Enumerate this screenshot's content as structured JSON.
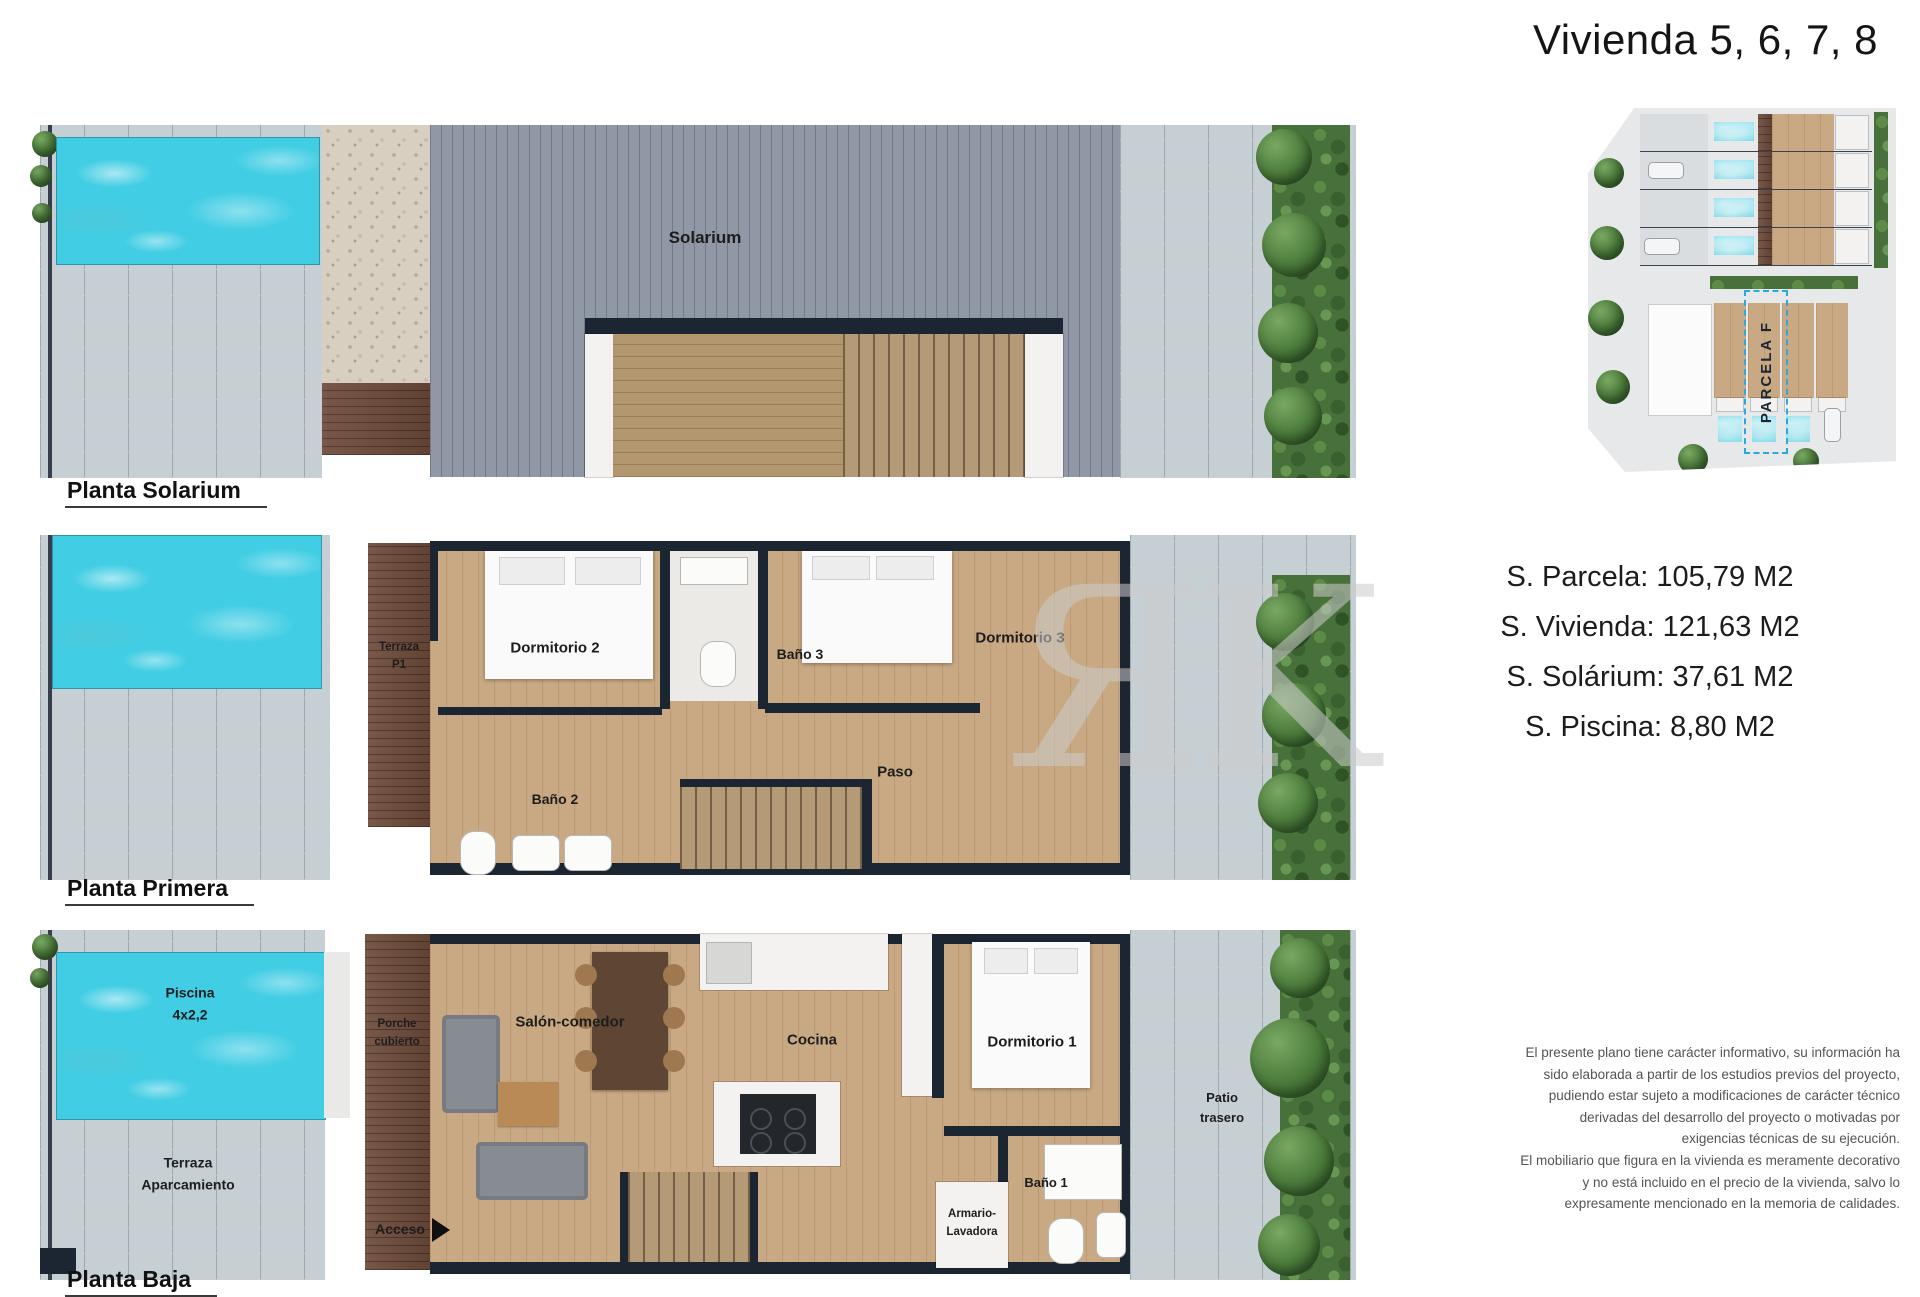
{
  "title": "Vivienda 5, 6, 7, 8",
  "watermark": "ЯK",
  "plans": {
    "solarium": {
      "label": "Planta Solarium",
      "rooms": {
        "solarium": "Solarium"
      }
    },
    "primera": {
      "label": "Planta Primera",
      "rooms": {
        "terraza_p1": "Terraza\nP1",
        "dormitorio2": "Dormitorio 2",
        "bano3": "Baño 3",
        "dormitorio3": "Dormitorio 3",
        "bano2": "Baño 2",
        "paso": "Paso"
      }
    },
    "baja": {
      "label": "Planta Baja",
      "rooms": {
        "piscina": "Piscina\n4x2,2",
        "terraza_aparcamiento": "Terraza\nAparcamiento",
        "porche": "Porche\ncubierto",
        "salon": "Salón-comedor",
        "cocina": "Cocina",
        "dormitorio1": "Dormitorio 1",
        "armario": "Armario-\nLavadora",
        "bano1": "Baño 1",
        "acceso": "Acceso",
        "patio": "Patio\ntrasero"
      }
    }
  },
  "site_plan": {
    "parcel_label": "PARCELA F"
  },
  "areas": [
    "S. Parcela: 105,79 M2",
    "S. Vivienda: 121,63 M2",
    "S. Solárium: 37,61 M2",
    "S. Piscina: 8,80 M2"
  ],
  "disclaimer": [
    "El presente plano tiene carácter informativo, su información ha sido elaborada a partir de los estudios previos del proyecto, pudiendo estar sujeto a modificaciones de carácter técnico derivadas del desarrollo del proyecto o motivadas por exigencias técnicas de su ejecución.",
    "El mobiliario que figura en la vivienda es meramente decorativo y no está incluido en el precio de la vivienda, salvo lo expresamente mencionado en la memoria de calidades."
  ],
  "colors": {
    "pool": "#41cde4",
    "wall": "#1c2532",
    "floor": "#c8a983",
    "deck_gray": "#9098a6",
    "wood_dark": "#6e4b3a",
    "paving": "#c6cfd3",
    "hedge": "#47703a",
    "parcel_accent": "#2aa9e0",
    "watermark": "#cccccc"
  }
}
